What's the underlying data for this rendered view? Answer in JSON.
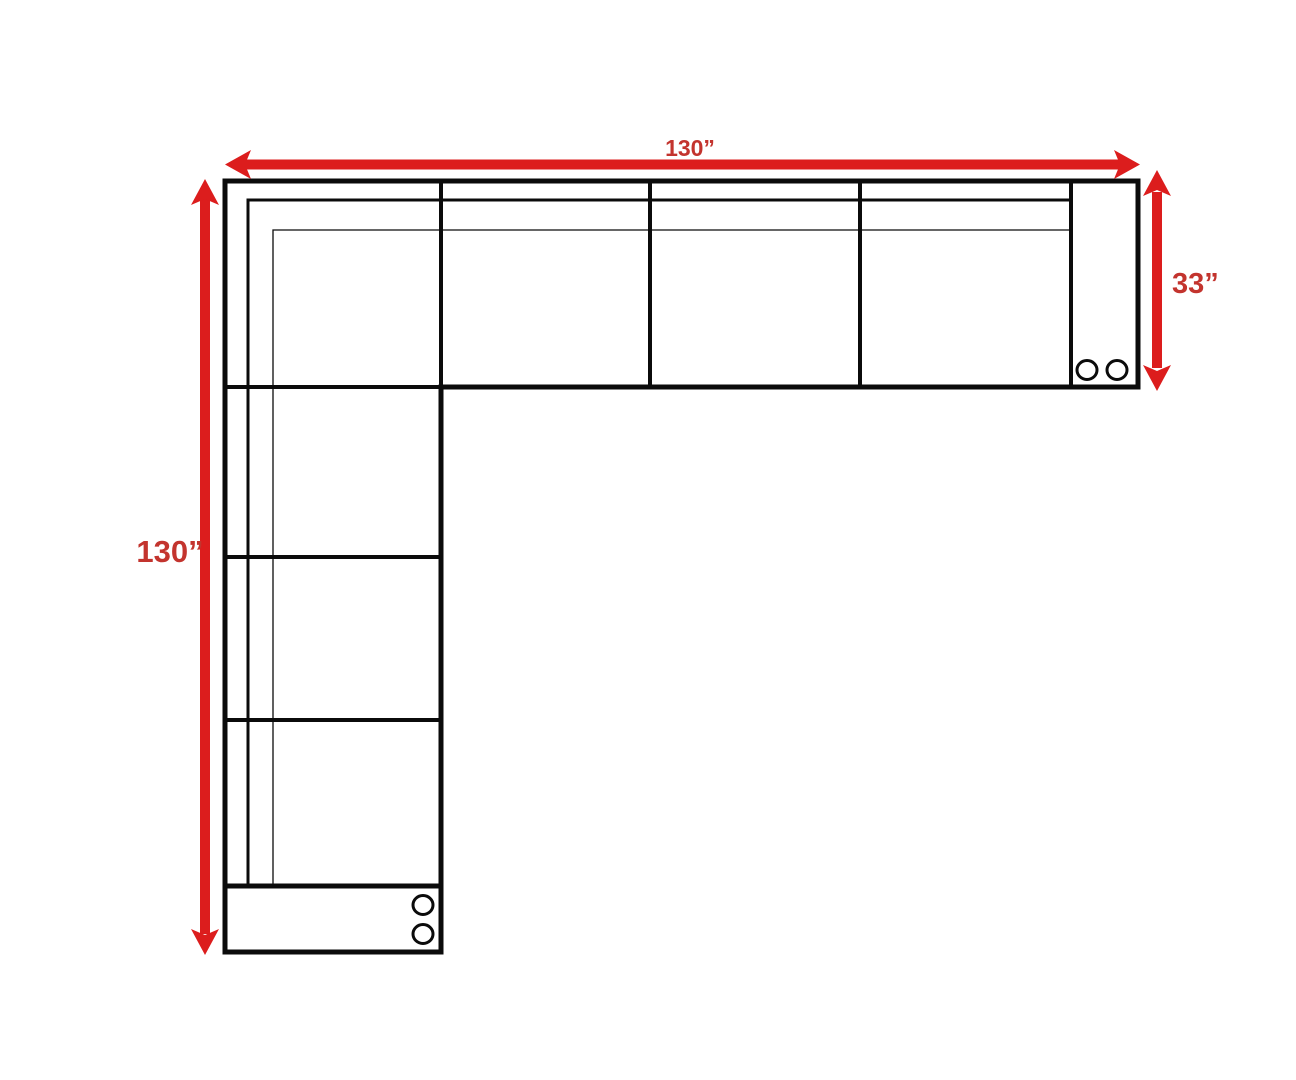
{
  "diagram": {
    "kind": "sectional-sofa-floor-plan",
    "labels": {
      "top_width": "130”",
      "left_height": "130”",
      "right_depth": "33”"
    },
    "structure": {
      "horizontal_arm_cells": 5,
      "vertical_arm_cells": 4,
      "caster_circles": 4
    },
    "colors": {
      "arrow_red": "#DC1D1D",
      "label_red": "#C3342E",
      "line_black": "#0B0B0B",
      "background": "#FFFFFF"
    }
  }
}
